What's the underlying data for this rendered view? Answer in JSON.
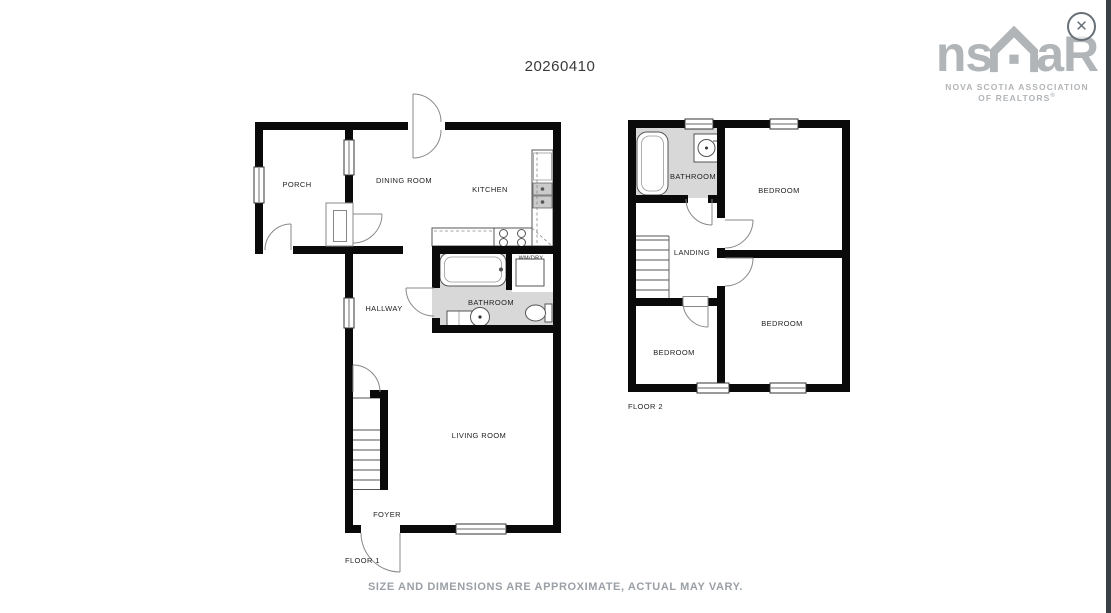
{
  "header": {
    "plan_number": "20260410"
  },
  "logo": {
    "brand_left": "ns",
    "brand_right": "aR",
    "line1": "NOVA SCOTIA ASSOCIATION",
    "line2_prefix": "OF",
    "realtors": "REALTORS",
    "reg": "®"
  },
  "icons": {
    "close": "✕"
  },
  "floor1": {
    "label": "FLOOR 1",
    "rooms": {
      "porch": "PORCH",
      "dining_room": "DINING ROOM",
      "kitchen": "KITCHEN",
      "hallway": "HALLWAY",
      "bathroom": "BATHROOM",
      "wm_dry": "WM/DRY",
      "living_room": "LIVING ROOM",
      "foyer": "FOYER"
    }
  },
  "floor2": {
    "label": "FLOOR 2",
    "rooms": {
      "bathroom": "BATHROOM",
      "bedroom_top": "BEDROOM",
      "landing": "LANDING",
      "bedroom_left": "BEDROOM",
      "bedroom_right": "BEDROOM"
    }
  },
  "footer": {
    "disclaimer": "SIZE AND DIMENSIONS ARE APPROXIMATE, ACTUAL MAY VARY."
  },
  "colors": {
    "wall": "#0a0a0a",
    "bathroom_floor": "#d8d8d8",
    "logo_gray": "#b1b5b8",
    "disclaimer_gray": "#9aa0a6",
    "edge_bar": "#3a4046"
  }
}
